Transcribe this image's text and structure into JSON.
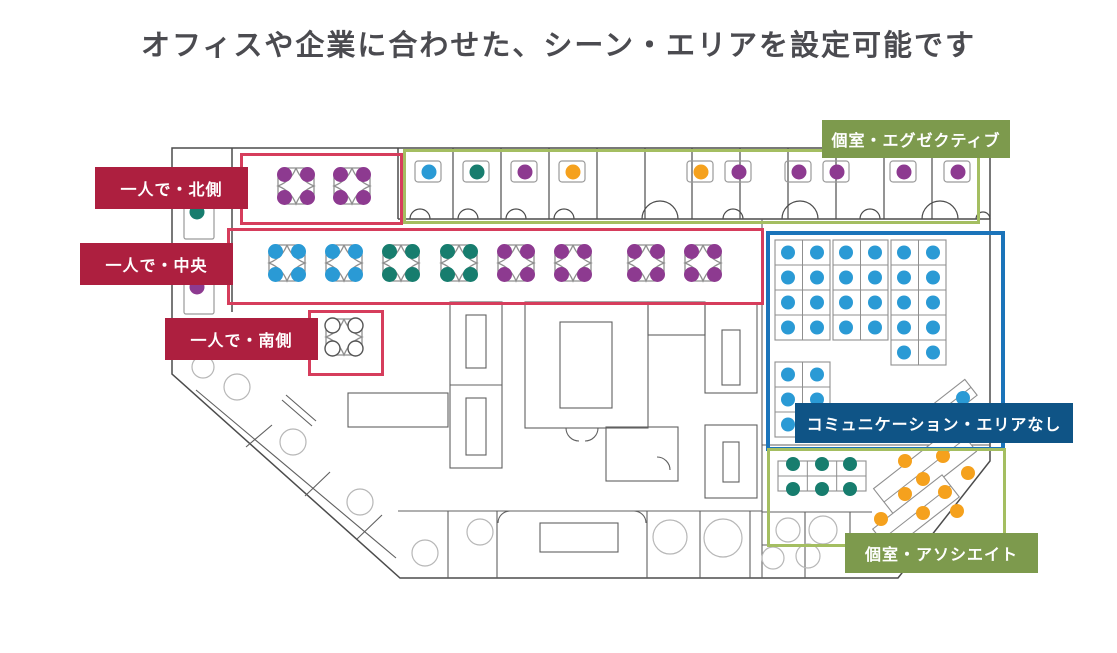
{
  "title": "オフィスや企業に合わせた、シーン・エリアを設定可能です",
  "areas": {
    "north": {
      "label": "一人で・北側",
      "style": "red"
    },
    "center": {
      "label": "一人で・中央",
      "style": "red"
    },
    "south": {
      "label": "一人で・南側",
      "style": "red"
    },
    "executive": {
      "label": "個室・エグゼクティブ",
      "style": "olive"
    },
    "communication": {
      "label": "コミュニケーション・エリアなし",
      "style": "blue"
    },
    "associate": {
      "label": "個室・アソシエイト",
      "style": "olive"
    }
  },
  "palette": {
    "title_color": "#4b4b50",
    "label_red": "#ad1f3f",
    "box_red": "#d63d5c",
    "label_olive": "#7d9a4d",
    "box_olive": "#a4be61",
    "label_blue": "#0f5486",
    "box_blue": "#1b74ba",
    "dot_blue": "#2a9ad5",
    "dot_teal": "#177d6e",
    "dot_purple": "#8d3a90",
    "dot_orange": "#f5a11d"
  },
  "floor": {
    "executive_room_dots": [
      {
        "x": 428,
        "c": "blue"
      },
      {
        "x": 476,
        "c": "teal"
      },
      {
        "x": 524,
        "c": "purple"
      },
      {
        "x": 572,
        "c": "orange"
      },
      {
        "x": 700,
        "c": "orange"
      },
      {
        "x": 738,
        "c": "purple"
      },
      {
        "x": 798,
        "c": "purple"
      },
      {
        "x": 836,
        "c": "purple"
      },
      {
        "x": 903,
        "c": "purple"
      },
      {
        "x": 957,
        "c": "purple"
      }
    ],
    "left_wall_desks": [
      {
        "x": 197,
        "y": 212,
        "c": "teal"
      },
      {
        "x": 197,
        "y": 287,
        "c": "purple"
      }
    ],
    "clusters": [
      {
        "cx": 296,
        "cy": 186,
        "c": "purple"
      },
      {
        "cx": 352,
        "cy": 186,
        "c": "purple"
      },
      {
        "cx": 287,
        "cy": 263,
        "c": "blue"
      },
      {
        "cx": 344,
        "cy": 263,
        "c": "blue"
      },
      {
        "cx": 401,
        "cy": 263,
        "c": "teal"
      },
      {
        "cx": 459,
        "cy": 263,
        "c": "teal"
      },
      {
        "cx": 516,
        "cy": 263,
        "c": "purple"
      },
      {
        "cx": 573,
        "cy": 263,
        "c": "purple"
      },
      {
        "cx": 646,
        "cy": 263,
        "c": "purple"
      },
      {
        "cx": 703,
        "cy": 263,
        "c": "purple"
      },
      {
        "cx": 344,
        "cy": 337,
        "c": "empty"
      }
    ],
    "bench_dot_color": "blue",
    "benches": [
      {
        "x": 775,
        "y": 240,
        "rows": 4
      },
      {
        "x": 833,
        "y": 240,
        "rows": 4
      },
      {
        "x": 891,
        "y": 240,
        "rows": 5
      },
      {
        "x": 775,
        "y": 362,
        "rows": 3
      }
    ],
    "teal_bench": {
      "x": 778,
      "y": 461,
      "w": 88,
      "h": 30,
      "dots": [
        [
          793,
          464
        ],
        [
          822,
          464
        ],
        [
          850,
          464
        ],
        [
          793,
          489
        ],
        [
          822,
          489
        ],
        [
          850,
          489
        ]
      ]
    },
    "diagonal_desks": [
      {
        "cx": 925,
        "cy": 470,
        "w": 104,
        "h": 34,
        "rot": -38
      },
      {
        "cx": 916,
        "cy": 513,
        "w": 88,
        "h": 28,
        "rot": -38
      },
      {
        "cx": 956,
        "cy": 399,
        "w": 38,
        "h": 20,
        "rot": -38
      }
    ],
    "orange_dots": [
      [
        905,
        461
      ],
      [
        943,
        456
      ],
      [
        968,
        473
      ],
      [
        923,
        479
      ],
      [
        905,
        494
      ],
      [
        945,
        492
      ],
      [
        881,
        519
      ],
      [
        923,
        513
      ],
      [
        957,
        511
      ]
    ],
    "blue_diag_dot": [
      963,
      398
    ],
    "gray_circles": [
      [
        203,
        367,
        11
      ],
      [
        237,
        387,
        13
      ],
      [
        293,
        442,
        13
      ],
      [
        360,
        502,
        13
      ],
      [
        425,
        553,
        13
      ],
      [
        480,
        532,
        13
      ],
      [
        670,
        537,
        17
      ],
      [
        723,
        538,
        19
      ],
      [
        788,
        530,
        12
      ],
      [
        823,
        530,
        14
      ],
      [
        773,
        558,
        11
      ],
      [
        808,
        556,
        12
      ]
    ]
  }
}
